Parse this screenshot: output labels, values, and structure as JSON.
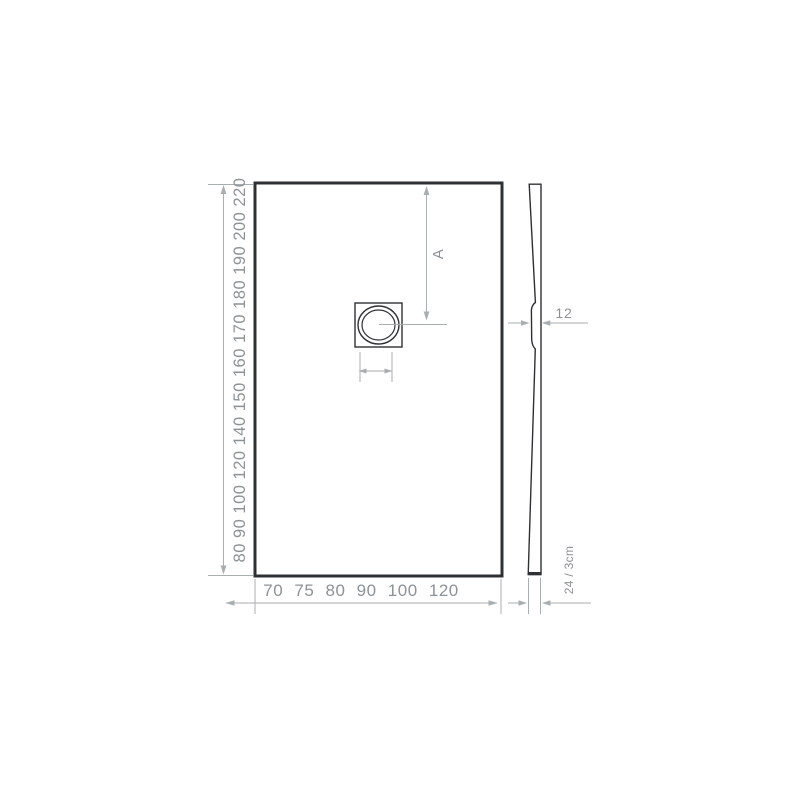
{
  "drawing": {
    "plan_view": {
      "length_labels": [
        "80",
        "90",
        "100",
        "120",
        "140",
        "150",
        "160",
        "170",
        "180",
        "190",
        "200",
        "220"
      ],
      "width_labels": [
        "70",
        "75",
        "80",
        "90",
        "100",
        "120"
      ],
      "drain_distance_label": "A"
    },
    "side_view": {
      "thickness_label": "12",
      "edge_height_label": "24 / 3cm"
    },
    "colors": {
      "outline": "#2e3133",
      "dimension_line": "#a9aeb1",
      "label_text": "#8d9296",
      "background": "#ffffff"
    }
  }
}
